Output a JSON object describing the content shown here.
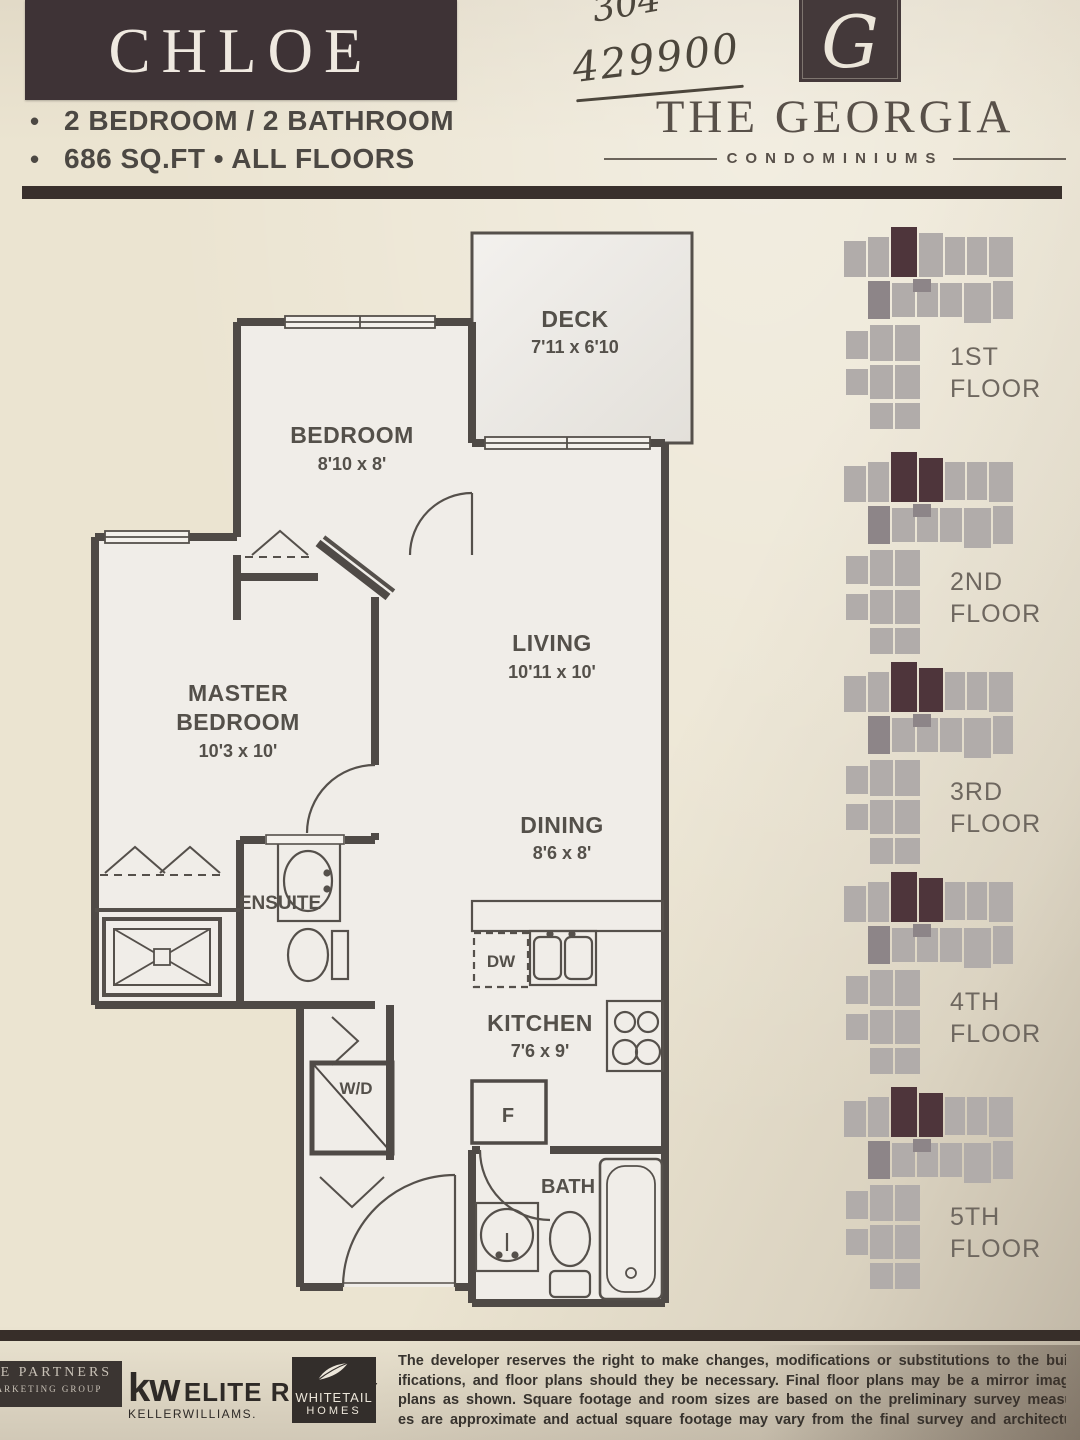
{
  "header": {
    "plan_name": "CHLOE",
    "bullet": "•",
    "features": [
      "2 BEDROOM / 2 BATHROOM",
      "686 SQ.FT • ALL FLOORS"
    ],
    "handwritten_note_top": "304",
    "handwritten_price": "429900",
    "brand": {
      "monogram": "G",
      "name": "THE GEORGIA",
      "tagline": "CONDOMINIUMS"
    }
  },
  "floor_plan": {
    "rooms": [
      {
        "name": "DECK",
        "dims": "7'11 x 6'10"
      },
      {
        "name": "BEDROOM",
        "dims": "8'10 x 8'"
      },
      {
        "name": "LIVING",
        "dims": "10'11 x 10'"
      },
      {
        "name_line1": "MASTER",
        "name_line2": "BEDROOM",
        "dims": "10'3 x 10'"
      },
      {
        "name": "DINING",
        "dims": "8'6 x 8'"
      },
      {
        "name": "ENSUITE"
      },
      {
        "name": "KITCHEN",
        "dims": "7'6 x 9'"
      },
      {
        "name": "BATH"
      }
    ],
    "appliances": {
      "washer_dryer": "W/D",
      "dishwasher": "DW",
      "fridge": "F"
    }
  },
  "floors": [
    {
      "line1": "1ST",
      "line2": "FLOOR",
      "highlighted_units": 1
    },
    {
      "line1": "2ND",
      "line2": "FLOOR",
      "highlighted_units": 2
    },
    {
      "line1": "3RD",
      "line2": "FLOOR",
      "highlighted_units": 2
    },
    {
      "line1": "4TH",
      "line2": "FLOOR",
      "highlighted_units": 2
    },
    {
      "line1": "5TH",
      "line2": "FLOOR",
      "highlighted_units": 2
    }
  ],
  "footer": {
    "partners_logo": {
      "line1": "THE PARTNERS",
      "line2": "MARKETING GROUP"
    },
    "kw_logo": {
      "kw": "kw",
      "name": "ELITE REALTY",
      "sub": "KELLERWILLIAMS."
    },
    "whitetail_logo": {
      "line1": "WHITETAIL",
      "line2": "HOMES"
    },
    "disclaimer_lines": [
      "The developer reserves the right to make changes, modifications or substitutions to the building design, s",
      "ifications, and floor plans should they be necessary. Final floor plans may be a mirror image of the",
      "plans as shown. Square footage and room sizes are based on the preliminary survey measurements",
      "es are approximate and actual square footage may vary from the final survey and architectural draw"
    ]
  },
  "colors": {
    "paper": "#ebe4d1",
    "accent_dark": "#3e3336",
    "wall": "#4f4a46",
    "plate_gray": "#b1acaa",
    "plate_medium": "#8d8588",
    "plate_highlight": "#4e353b"
  }
}
